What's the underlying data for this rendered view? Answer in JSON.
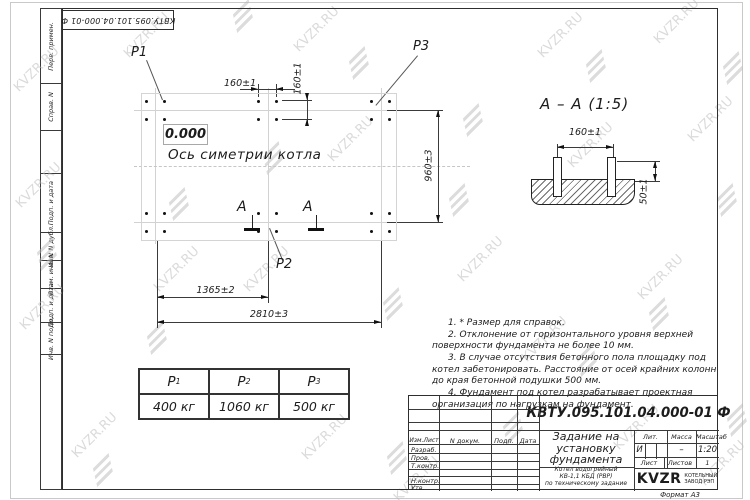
{
  "sheet": {
    "stamp_number": "КВТУ.095.101.04.000-01 Ф",
    "format_label": "Формат А3",
    "watermark_text": "KVZR.RU"
  },
  "margin": {
    "labels": [
      "Перв. примен.",
      "Справ. N",
      "Подп. и дата",
      "Инв. N дубл.",
      "Взам. инв. N",
      "Подп. и дата",
      "Инв. N подл."
    ]
  },
  "plan": {
    "level_mark": "0.000",
    "axis_label": "Ось симетрии котла",
    "load_p1": "P1",
    "load_p2": "P2",
    "load_p3": "P3",
    "section_letter": "А",
    "dim_bolt_h": "160±1",
    "dim_bolt_v": "160±1",
    "dim_height": "960±3",
    "dim_mid": "1365±2",
    "dim_total": "2810±3"
  },
  "section": {
    "title": "А – А (1:5)",
    "dim_spacing": "160±1",
    "dim_protrusion": "50±1"
  },
  "load_table": {
    "headers": [
      {
        "base": "P",
        "sub": "1"
      },
      {
        "base": "P",
        "sub": "2"
      },
      {
        "base": "P",
        "sub": "3"
      }
    ],
    "values": [
      "400 кг",
      "1060 кг",
      "500 кг"
    ]
  },
  "notes": [
    "1.  * Размер для справок.",
    "2.  Отклонение от горизонтального уровня верхней поверхности фундамента не более 10 мм.",
    "3.  В случае отсутствия бетонного пола площадку под котел забетонировать. Расстояние от осей крайних колонн до края бетонной подушки 500 мм.",
    "4.  Фундамент под котел разрабатывает проектная организация по нагрузкам на фундамент."
  ],
  "title_block": {
    "doc_number": "КВТУ.095.101.04.000-01 Ф",
    "title_lines": [
      "Задание на",
      "установку",
      "фундамента"
    ],
    "subtitle_lines": [
      "Котел водогрейный",
      "КВ-1,1 КБД (РВР)",
      "по техническому задание"
    ],
    "header_cols": [
      "Изм.Лист",
      "N докум.",
      "Подп.",
      "Дата"
    ],
    "row_labels": [
      "Разраб.",
      "Пров.",
      "Т.контр.",
      "Н.контр.",
      "Утв."
    ],
    "lit_header": "Лит.",
    "mass_header": "Масса",
    "scale_header": "Масштаб",
    "lit_value": "И",
    "mass_value": "–",
    "scale_value": "1:20",
    "sheet_label": "Лист",
    "sheets_label": "Листов",
    "sheets_value": "1",
    "logo_text": "KVZR",
    "logo_caption": [
      "КОТЕЛЬНЫЙ",
      "ЗАВОД РЭП"
    ]
  }
}
